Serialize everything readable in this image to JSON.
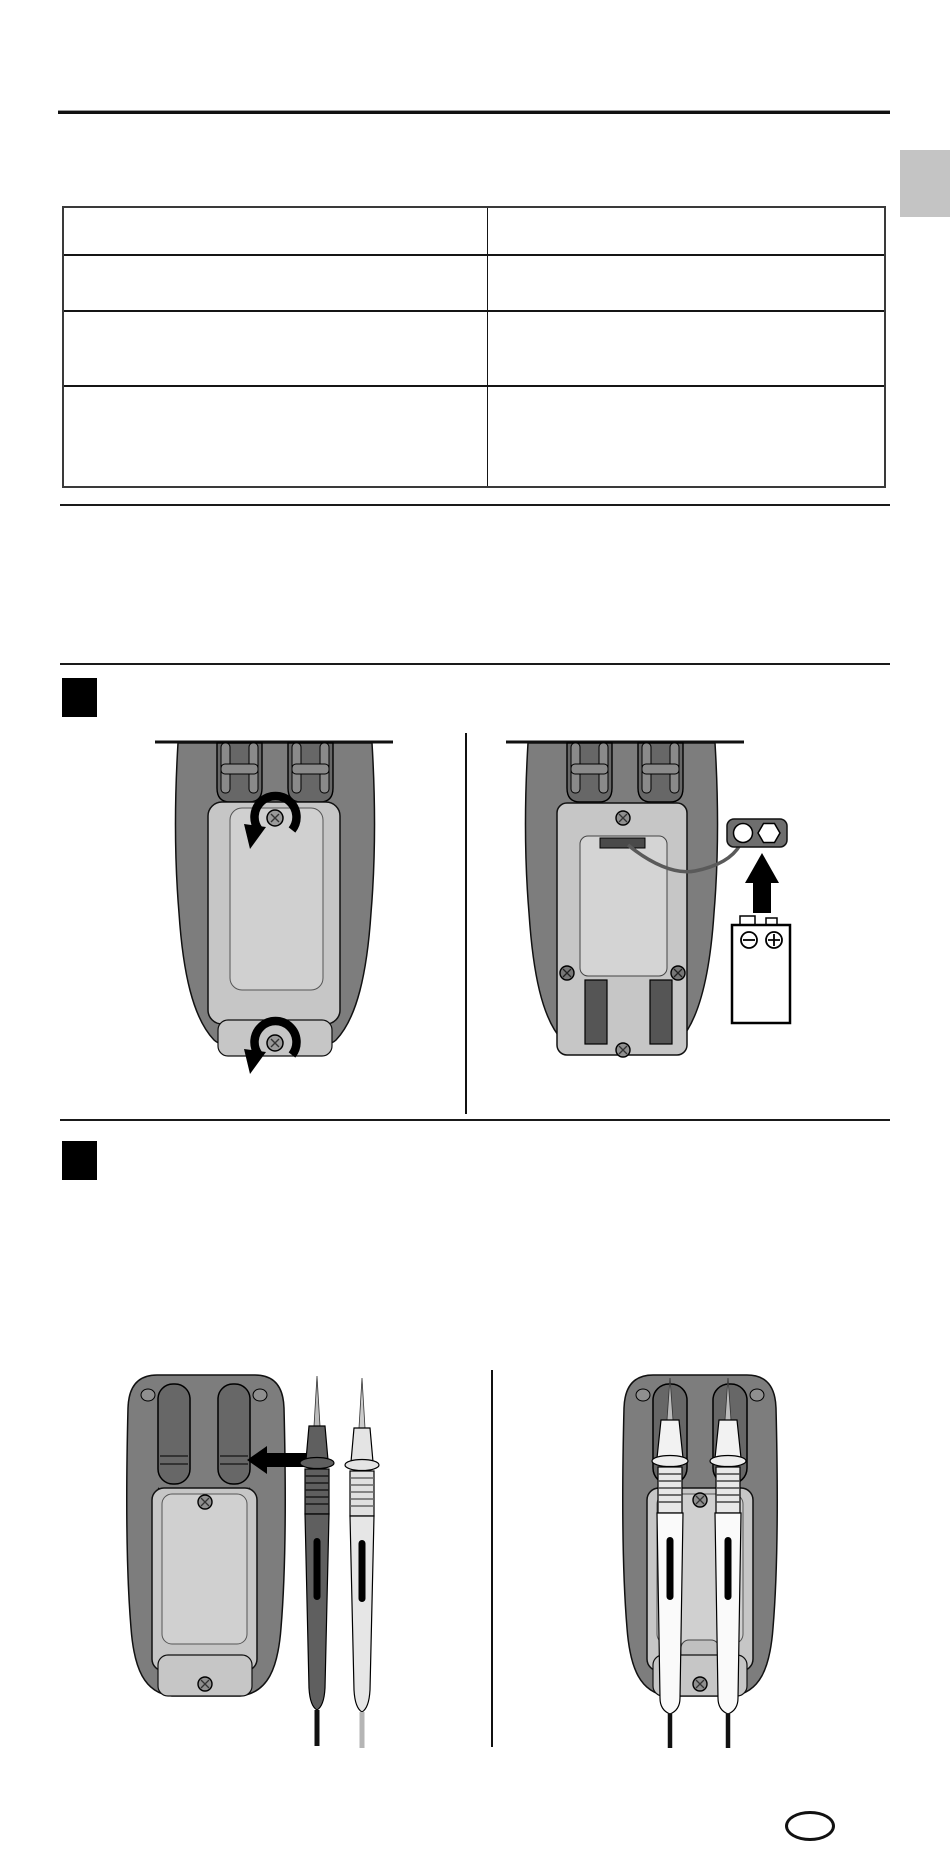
{
  "document": {
    "type": "instruction-manual-page",
    "background": "#ffffff"
  },
  "side_tab": {
    "color": "#c4c4c4"
  },
  "table": {
    "rows": [
      {
        "cells": [
          "",
          ""
        ]
      },
      {
        "cells": [
          "",
          ""
        ]
      },
      {
        "cells": [
          "",
          ""
        ]
      },
      {
        "cells": [
          "",
          ""
        ]
      }
    ]
  },
  "section_markers": [
    {
      "icon": "black-square-marker"
    },
    {
      "icon": "black-square-marker"
    }
  ],
  "figures": [
    {
      "id": "battery-replacement",
      "panels": [
        {
          "icon": "multimeter-back-battery-cover-screws-with-rotate-ccw-arrows"
        },
        {
          "icon": "multimeter-open-compartment-with-9v-battery-connector-and-up-arrow"
        }
      ]
    },
    {
      "id": "probe-storage",
      "panels": [
        {
          "icon": "multimeter-back-with-two-test-probes-and-left-arrow"
        },
        {
          "icon": "multimeter-back-with-probes-clipped-in-holders"
        }
      ]
    }
  ],
  "colors": {
    "meter_body": "#7d7d7d",
    "channel": "#676767",
    "channel_strap": "#8a8a8a",
    "panel": "#c6c6c6",
    "panel_inner": "#d0d0d0",
    "well": "#d4d4d4",
    "dark_detail": "#4a4a4a",
    "probe_dark": "#5f5f5f",
    "probe_light": "#e4e4e4",
    "connector": "#6e6e6e",
    "arrow": "#000000",
    "rule": "#1a1a1a",
    "table_border": "#3a3a3a"
  },
  "footer_oval": {
    "text": ""
  }
}
